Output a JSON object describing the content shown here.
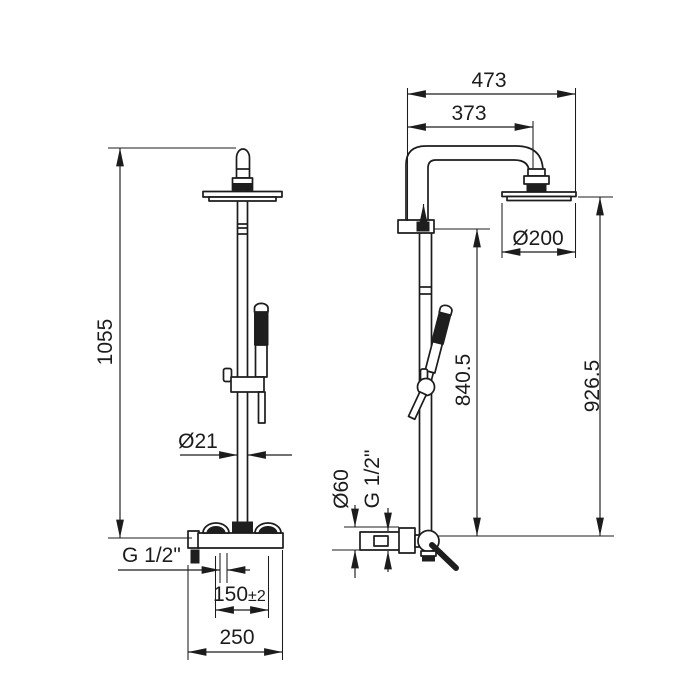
{
  "front_view": {
    "height": "1055",
    "pipe_diameter": "Ø21",
    "inlet_thread": "G 1/2\"",
    "inlet_spacing": "150",
    "inlet_spacing_tolerance": "±2",
    "body_width": "250"
  },
  "side_view": {
    "overall_depth": "473",
    "arm_projection": "373",
    "head_diameter": "Ø200",
    "height_to_head": "926.5",
    "height_to_arm": "840.5",
    "escutcheon_diameter": "Ø60",
    "outlet_thread": "G 1/2\""
  },
  "colors": {
    "line": "#1c1c1c",
    "background": "#ffffff"
  }
}
